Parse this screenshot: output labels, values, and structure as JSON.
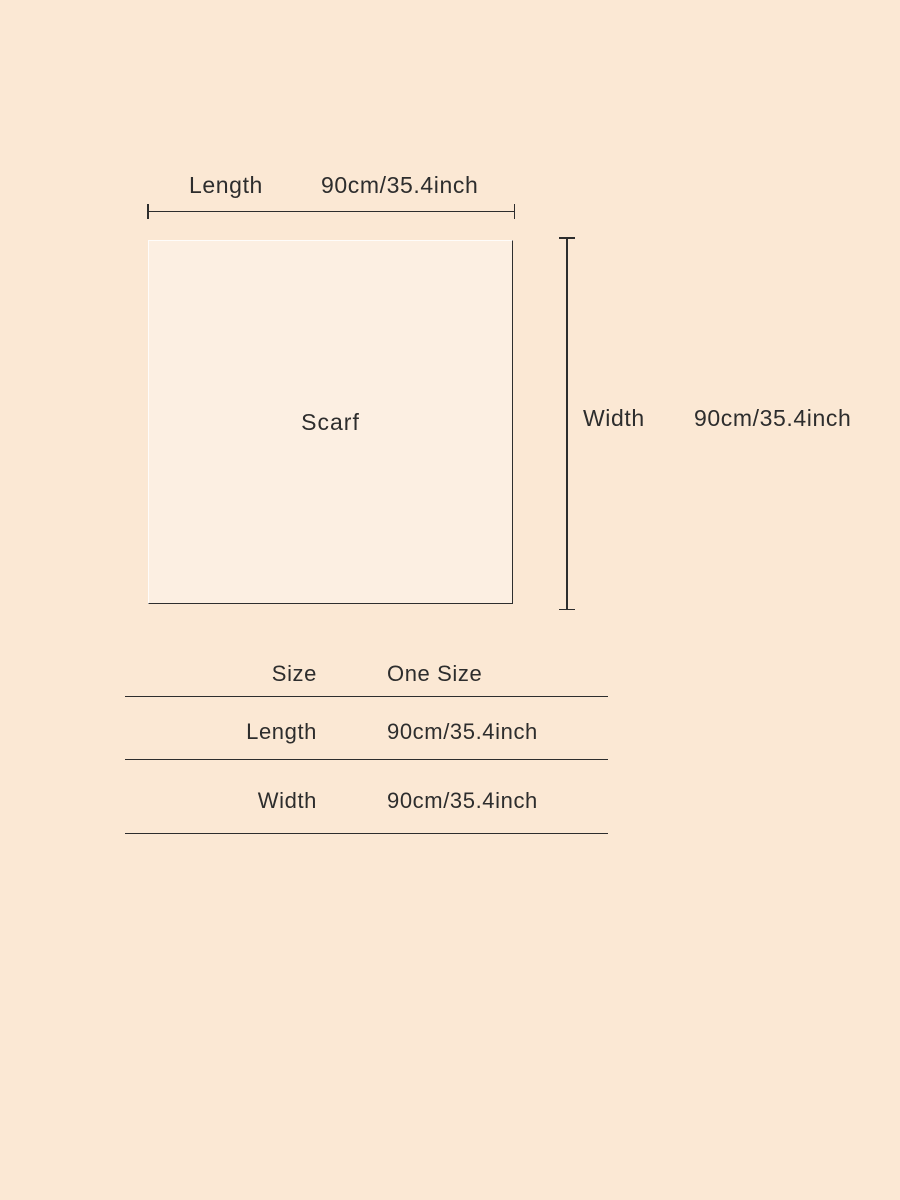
{
  "page": {
    "background_color": "#fbe8d4",
    "text_color": "#2d2d2d",
    "line_color": "#2d2d2d"
  },
  "diagram": {
    "item_label": "Scarf",
    "length": {
      "label": "Length",
      "value": "90cm/35.4inch"
    },
    "width": {
      "label": "Width",
      "value": "90cm/35.4inch"
    }
  },
  "size_table": {
    "headers": [
      "Size",
      "One Size"
    ],
    "rows": [
      {
        "label": "Length",
        "value": "90cm/35.4inch"
      },
      {
        "label": "Width",
        "value": "90cm/35.4inch"
      }
    ]
  }
}
